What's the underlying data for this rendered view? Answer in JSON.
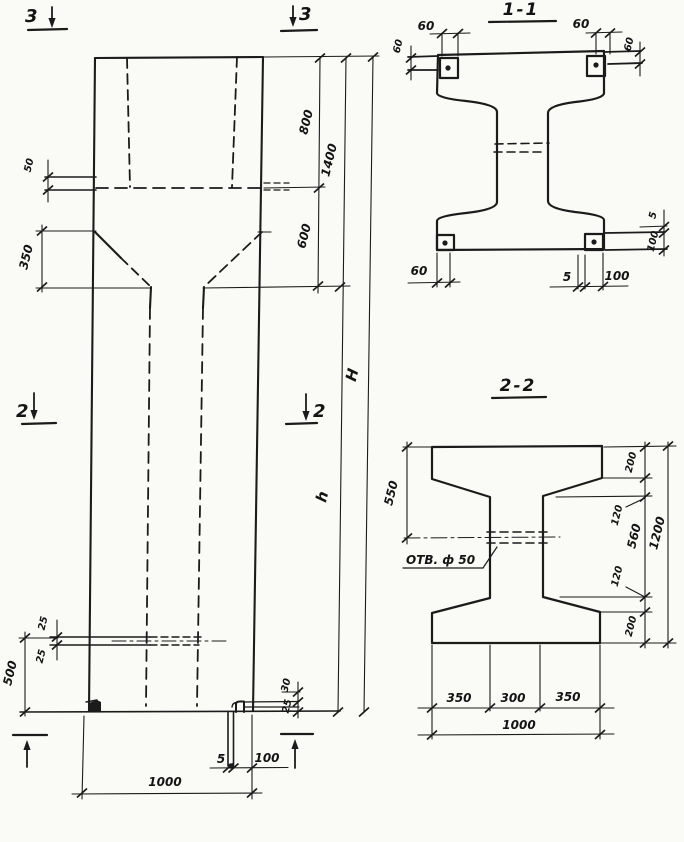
{
  "drawing": {
    "type": "structural concrete column working drawing",
    "ink": "#1b1b1b",
    "paper": "#fafaf7"
  },
  "elevation": {
    "markers": {
      "top_left": "3",
      "top_right": "3",
      "mid_left": "2",
      "mid_right": "2",
      "bottom_left": "1",
      "bottom_right": "1"
    },
    "dims": {
      "ledge": "50",
      "taper": "350",
      "top_segment": "800",
      "mid_segment": "600",
      "upper_total": "1400",
      "total_height": "H",
      "lower_height": "h",
      "hole_upper": "25",
      "hole_lower": "25",
      "hole_to_base": "500",
      "notch_a": "30",
      "notch_b": "25",
      "plate_gap": "5",
      "plate_width": "100",
      "base_width": "1000"
    }
  },
  "section11": {
    "title": "1-1",
    "dims": {
      "plate_tl": "60",
      "side_left": "60",
      "plate_tr": "60",
      "side_right": "60",
      "plate_bl": "60",
      "bottom_gap": "5",
      "bottom_plate": "100",
      "right_gap": "5",
      "right_plate": "100"
    }
  },
  "section22": {
    "title": "2-2",
    "hole_label": "ОТВ. ф 50",
    "dims": {
      "left_to_hole": "550",
      "top_flange": "200",
      "web_top": "120",
      "web_height": "560",
      "web_bottom": "120",
      "bottom_flange": "200",
      "total_height": "1200",
      "bottom_left": "350",
      "bottom_mid": "300",
      "bottom_right": "350",
      "bottom_total": "1000"
    }
  }
}
